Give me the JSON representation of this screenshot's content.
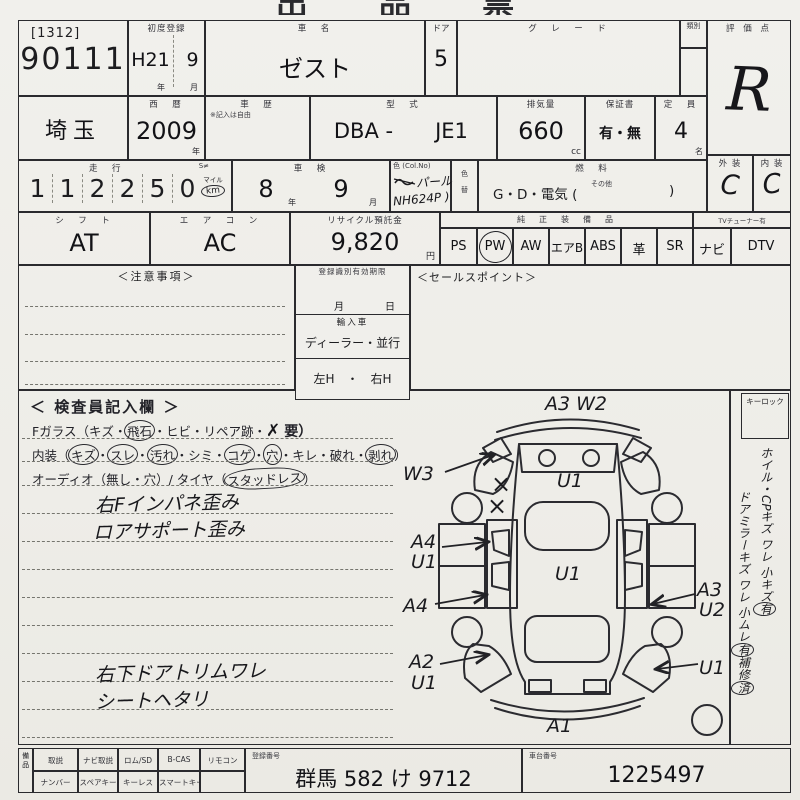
{
  "page": {
    "title_top": "出 品 票"
  },
  "head": {
    "lot_bracket": "[1312]",
    "lot_number": "90111",
    "first_reg": {
      "label": "初度登録",
      "era": "H21",
      "month": "9",
      "unit_year": "年",
      "unit_month": "月"
    },
    "car_name": {
      "label": "車　名",
      "value": "ゼスト"
    },
    "doors": {
      "label": "ドア",
      "value": "5"
    },
    "grade_label": "グ　レ　ー　ド",
    "ruibetsu_label": "類別",
    "score": {
      "label": "評 価 点",
      "value": "R"
    }
  },
  "row2": {
    "prefecture": "埼玉",
    "seireki": {
      "label": "西　暦",
      "value": "2009",
      "unit": "年"
    },
    "shareki": {
      "label": "車　歴",
      "note": "※記入は自由"
    },
    "katashiki": {
      "label": "型　式",
      "prefix": "DBA -",
      "value": "JE1"
    },
    "displacement": {
      "label": "排気量",
      "value": "660",
      "unit": "cc"
    },
    "warranty": {
      "label": "保証書",
      "value": "有・無"
    },
    "capacity": {
      "label": "定　員",
      "value": "4",
      "unit": "名"
    }
  },
  "row3": {
    "mileage": {
      "label": "走　行",
      "s_mark": "S≠",
      "digits": [
        "1",
        "1",
        "2",
        "2",
        "5",
        "0"
      ],
      "unit_top": "マイル",
      "unit_bottom": "km"
    },
    "shaken": {
      "label": "車　検",
      "year": "8",
      "unit_year": "年",
      "month": "9",
      "unit_month": "月"
    },
    "color": {
      "label": "色 (Col.No)",
      "hand_line1": "パール",
      "hand_line2": "NH624P )"
    },
    "iro_gae": {
      "label_top": "色",
      "label_bottom": "替"
    },
    "fuel": {
      "label": "燃　料",
      "value": "G・D・電気 (",
      "sonota": "その他",
      "close": ")"
    },
    "exterior": {
      "label": "外 装",
      "value": "C"
    },
    "interior": {
      "label": "内 装",
      "value": "C"
    }
  },
  "row4": {
    "shift": {
      "label": "シ　フ　ト",
      "value": "AT"
    },
    "aircon": {
      "label": "エ　ア　コ　ン",
      "value": "AC"
    },
    "recycle": {
      "label": "リサイクル預託金",
      "value": "9,820",
      "unit": "円"
    },
    "equipment": {
      "header": "純　正　装　備　品",
      "tuner_note": "TVチューナー有",
      "items": [
        "PS",
        "PW",
        "AW",
        "エアB",
        "ABS",
        "革",
        "SR",
        "ナビ",
        "DTV"
      ],
      "circled_item": "PW"
    }
  },
  "row5": {
    "notice_label": "＜注意事項＞",
    "reg_block": {
      "title": "登録識別有効期限",
      "month": "月",
      "day": "日",
      "import_label": "輸入車",
      "import_value": "ディーラー・並行",
      "handle": "左H　・　右H"
    },
    "sales_label": "＜セールスポイント＞"
  },
  "inspector": {
    "title": "＜ 検査員記入欄 ＞",
    "fglass": {
      "prefix": "Fガラス（キズ・",
      "circled": "飛石",
      "mid": "・ヒビ・リペア跡・",
      "cross": "✗",
      "suffix": "要）"
    },
    "interior_line": {
      "prefix": "内装（",
      "sep": "・",
      "items": [
        {
          "t": "キズ",
          "c": true
        },
        {
          "t": "スレ",
          "c": true
        },
        {
          "t": "汚れ",
          "c": true
        },
        {
          "t": "シミ",
          "c": false
        },
        {
          "t": "コゲ",
          "c": true
        },
        {
          "t": "穴",
          "c": true
        },
        {
          "t": "キレ",
          "c": false
        },
        {
          "t": "破れ",
          "c": false
        },
        {
          "t": "剥れ",
          "c": true
        }
      ],
      "suffix": "）"
    },
    "audio_line": {
      "prefix": "オーディオ（無し・穴）/ タイヤ（",
      "circled": "スタッドレス",
      "suffix": "）"
    },
    "notes_upper": [
      "右Fインパネ歪み",
      "ロアサポート歪み"
    ],
    "notes_lower": [
      "右下ドアトリムワレ",
      "シートヘタリ"
    ]
  },
  "diagram": {
    "labels": {
      "top": "A3  W2",
      "w3": "W3",
      "x1": "×",
      "x2": "×",
      "hatch": "U1",
      "a4_1": "A4",
      "u1_1": "U1",
      "roof": "U1",
      "a4_2": "A4",
      "a3_r": "A3",
      "u2_r": "U2",
      "a2": "A2",
      "u1_b": "U1",
      "u1_r": "U1",
      "front": "A1"
    }
  },
  "sidebar": {
    "keylock": "キーロック",
    "line1": "ホイル・CPキズ ワレ",
    "line2_pre": "小キズ",
    "line2_circ": "有",
    "line3": "ドアミラーキズ ワレ",
    "line4_pre": "小ムレ",
    "line4_circ": "有",
    "line5_pre": "補修",
    "line5_circ": "済"
  },
  "bottom": {
    "bihin_label": "備品",
    "row1": [
      "取説",
      "ナビ取説",
      "ロム/SD",
      "B-CAS",
      "リモコン"
    ],
    "row2": [
      "ナンバー",
      "スペアキー",
      "キーレス",
      "スマートキー"
    ],
    "reg_no": {
      "label": "登録番号",
      "value": "群馬 582 け 9712"
    },
    "chassis": {
      "label": "車台番号",
      "value": "1225497"
    }
  }
}
